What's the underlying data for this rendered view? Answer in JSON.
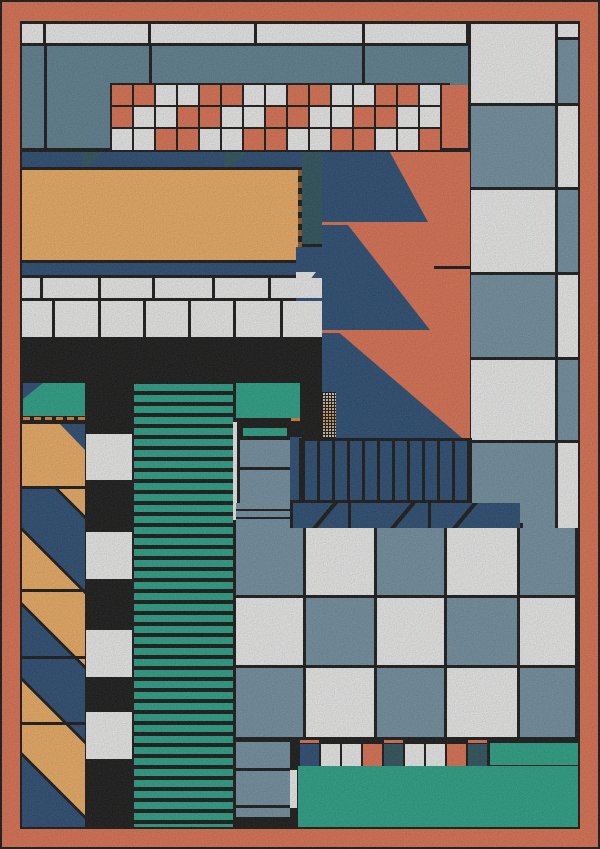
{
  "artwork": {
    "title_hint": "abstract-geometric-composition",
    "palette": {
      "black": "#181818",
      "coral": "#DC7152",
      "amber": "#EDAC63",
      "navy": "#2A4C72",
      "slate": "#7390A0",
      "slate2": "#5E808F",
      "dteal": "#2E525C",
      "teal": "#2AA185",
      "white": "#ECEDEC",
      "orange": "#E0812F",
      "dash": "#8A5A2D"
    },
    "letter_map": {
      "C": "coral",
      "W": "white",
      "S": "slate",
      "N": "navy",
      "D": "dteal",
      "O": "orange",
      "T": "teal",
      "K": "black",
      "A": "amber"
    },
    "tiles": [
      {
        "n": "outer-coral-border",
        "t": "rect",
        "x": 2,
        "y": 2,
        "w": 596,
        "h": 845,
        "c": "coral"
      },
      {
        "n": "inner-canvas",
        "t": "rect",
        "x": 20,
        "y": 21,
        "w": 560,
        "h": 808,
        "c": "black"
      },
      {
        "n": "top-white-row",
        "t": "cells",
        "x": 22,
        "y": 24,
        "cw": [
          21,
          102,
          103,
          105,
          101
        ],
        "rh": [
          19
        ],
        "gap": 3,
        "rows": [
          "WWWWW"
        ]
      },
      {
        "n": "top-slate-field",
        "t": "rect",
        "x": 22,
        "y": 46,
        "w": 446,
        "h": 102,
        "c": "slate2"
      },
      {
        "n": "top-slate-divider",
        "t": "rect",
        "x": 44,
        "y": 46,
        "w": 3,
        "h": 102,
        "c": "black"
      },
      {
        "n": "top-slate-divider",
        "t": "rect",
        "x": 149,
        "y": 46,
        "w": 3,
        "h": 102,
        "c": "black"
      },
      {
        "n": "top-slate-divider",
        "t": "rect",
        "x": 362,
        "y": 46,
        "w": 3,
        "h": 102,
        "c": "black"
      },
      {
        "n": "mosaic-grid-base",
        "t": "rect",
        "x": 110,
        "y": 83,
        "w": 340,
        "h": 67,
        "c": "black"
      },
      {
        "n": "mosaic-grid",
        "t": "cells",
        "x": 112,
        "y": 85,
        "cw": [
          20,
          20,
          20,
          20,
          20,
          20,
          20,
          20,
          20,
          20,
          20,
          20,
          20,
          20,
          20
        ],
        "rh": [
          20,
          20,
          21
        ],
        "gap": 2,
        "gy": 2,
        "rows": [
          "CCWWCCWWCCWWCCW",
          "CWWCCWWCCWWCCWW",
          "WWCCWWCCWWCCWWC"
        ]
      },
      {
        "n": "mosaic-coral-cap",
        "t": "rect",
        "x": 442,
        "y": 85,
        "w": 26,
        "h": 63,
        "c": "coral"
      },
      {
        "n": "rightcol-white-a",
        "t": "rect",
        "x": 471,
        "y": 24,
        "w": 84,
        "h": 79,
        "c": "white"
      },
      {
        "n": "rightcol-cap",
        "t": "rect",
        "x": 558,
        "y": 24,
        "w": 20,
        "h": 13,
        "c": "white"
      },
      {
        "n": "rightcol-strip-a",
        "t": "rect",
        "x": 558,
        "y": 40,
        "w": 20,
        "h": 63,
        "c": "slate"
      },
      {
        "n": "rightcol-slate-b",
        "t": "rect",
        "x": 471,
        "y": 106,
        "w": 84,
        "h": 81,
        "c": "slate"
      },
      {
        "n": "rightcol-strip-b",
        "t": "rect",
        "x": 558,
        "y": 106,
        "w": 20,
        "h": 81,
        "c": "white"
      },
      {
        "n": "rightcol-white-c",
        "t": "rect",
        "x": 471,
        "y": 190,
        "w": 84,
        "h": 82,
        "c": "white"
      },
      {
        "n": "rightcol-strip-c",
        "t": "rect",
        "x": 558,
        "y": 190,
        "w": 20,
        "h": 82,
        "c": "slate"
      },
      {
        "n": "rightcol-slate-d",
        "t": "rect",
        "x": 471,
        "y": 275,
        "w": 84,
        "h": 82,
        "c": "slate"
      },
      {
        "n": "rightcol-strip-d",
        "t": "rect",
        "x": 558,
        "y": 275,
        "w": 20,
        "h": 82,
        "c": "white"
      },
      {
        "n": "rightcol-white-e",
        "t": "rect",
        "x": 471,
        "y": 360,
        "w": 84,
        "h": 80,
        "c": "white"
      },
      {
        "n": "rightcol-strip-e",
        "t": "rect",
        "x": 558,
        "y": 360,
        "w": 20,
        "h": 80,
        "c": "slate"
      },
      {
        "n": "rightcol-slate-f",
        "t": "rect",
        "x": 471,
        "y": 443,
        "w": 84,
        "h": 80,
        "c": "slate"
      },
      {
        "n": "rightcol-strip-f",
        "t": "rect",
        "x": 558,
        "y": 443,
        "w": 20,
        "h": 80,
        "c": "white"
      },
      {
        "n": "sawtooth-coral-field",
        "t": "rect",
        "x": 322,
        "y": 152,
        "w": 148,
        "h": 291,
        "c": "coral"
      },
      {
        "n": "sawtooth-tooth-1",
        "t": "poly",
        "x": 322,
        "y": 152,
        "w": 106,
        "h": 70,
        "c": "navy",
        "pts": "0 0,64% 0,100% 100%,0 100%"
      },
      {
        "n": "sawtooth-tooth-2",
        "t": "poly",
        "x": 322,
        "y": 225,
        "w": 108,
        "h": 105,
        "c": "navy",
        "pts": "0 0,24% 0,100% 100%,0 100%"
      },
      {
        "n": "sawtooth-tooth-3",
        "t": "poly",
        "x": 322,
        "y": 333,
        "w": 146,
        "h": 110,
        "c": "navy",
        "pts": "0 0,12% 0,100% 100%,0 100%"
      },
      {
        "n": "coral-seam",
        "t": "rect",
        "x": 434,
        "y": 266,
        "w": 36,
        "h": 3,
        "c": "black"
      },
      {
        "n": "navy-band",
        "t": "rect",
        "x": 22,
        "y": 152,
        "w": 300,
        "h": 15,
        "c": "navy"
      },
      {
        "n": "band-wedge",
        "t": "poly",
        "x": 82,
        "y": 152,
        "w": 22,
        "h": 15,
        "c": "dteal",
        "pts": "0 0,100% 0,25% 100%,0 100%"
      },
      {
        "n": "band-wedge",
        "t": "poly",
        "x": 224,
        "y": 152,
        "w": 24,
        "h": 15,
        "c": "dteal",
        "pts": "0 0,100% 0,25% 100%,0 100%"
      },
      {
        "n": "dteal-column",
        "t": "rect",
        "x": 302,
        "y": 152,
        "w": 20,
        "h": 92,
        "c": "dteal"
      },
      {
        "n": "amber-panel",
        "t": "rect",
        "x": 22,
        "y": 170,
        "w": 276,
        "h": 90,
        "c": "amber"
      },
      {
        "n": "amber-panel-dashed-edge",
        "t": "vdash",
        "x": 298,
        "y": 170,
        "w": 4,
        "h": 90
      },
      {
        "n": "navy-underline",
        "t": "rect",
        "x": 22,
        "y": 263,
        "w": 300,
        "h": 12,
        "c": "navy"
      },
      {
        "n": "navy-knuckle",
        "t": "rect",
        "x": 296,
        "y": 247,
        "w": 26,
        "h": 90,
        "c": "navy"
      },
      {
        "n": "white-wedge",
        "t": "poly",
        "x": 296,
        "y": 272,
        "w": 20,
        "h": 26,
        "c": "white",
        "pts": "0 0,100% 0,0 100%"
      },
      {
        "n": "white-row-a",
        "t": "cells",
        "x": 22,
        "y": 278,
        "cw": [
          18,
          55,
          51,
          57,
          53,
          51
        ],
        "rh": [
          20
        ],
        "gap": 3,
        "rows": [
          "WWWWWW"
        ]
      },
      {
        "n": "white-row-b",
        "t": "cells",
        "x": 22,
        "y": 301,
        "cw": [
          30,
          43,
          42,
          42,
          42,
          44,
          39
        ],
        "rh": [
          36
        ],
        "gap": 3,
        "rows": [
          "WWWWWWW"
        ]
      },
      {
        "n": "black-band",
        "t": "rect",
        "x": 22,
        "y": 340,
        "w": 300,
        "h": 43,
        "c": "black"
      },
      {
        "n": "teal-block",
        "t": "rect",
        "x": 23,
        "y": 383,
        "w": 62,
        "h": 33,
        "c": "teal"
      },
      {
        "n": "teal-block-wedge",
        "t": "poly",
        "x": 23,
        "y": 383,
        "w": 20,
        "h": 16,
        "c": "navy",
        "pts": "0 0,100% 0,0 100%"
      },
      {
        "n": "orange-tick-row",
        "t": "cells",
        "x": 23,
        "y": 417,
        "cw": [
          7,
          7,
          7,
          7,
          7,
          7
        ],
        "rh": [
          3
        ],
        "gap": 4,
        "rows": [
          "OOOOOO"
        ]
      },
      {
        "n": "amber-block",
        "t": "rect",
        "x": 22,
        "y": 424,
        "w": 63,
        "h": 62,
        "c": "amber"
      },
      {
        "n": "amber-block-wedge",
        "t": "poly",
        "x": 60,
        "y": 424,
        "w": 25,
        "h": 26,
        "c": "navy",
        "pts": "0 0,100% 0,100% 100%"
      },
      {
        "n": "diagonal-column",
        "t": "diag",
        "x": 22,
        "y": 489,
        "w": 63,
        "h": 338
      },
      {
        "n": "diag-rule",
        "t": "rect",
        "x": 22,
        "y": 589,
        "w": 63,
        "h": 3,
        "c": "black"
      },
      {
        "n": "diag-rule",
        "t": "rect",
        "x": 22,
        "y": 656,
        "w": 63,
        "h": 3,
        "c": "black"
      },
      {
        "n": "diag-rule",
        "t": "rect",
        "x": 22,
        "y": 722,
        "w": 63,
        "h": 3,
        "c": "black"
      },
      {
        "n": "checker-column-base",
        "t": "rect",
        "x": 85,
        "y": 383,
        "w": 48,
        "h": 444,
        "c": "black"
      },
      {
        "n": "checker-column-white",
        "t": "rect",
        "x": 86,
        "y": 434,
        "w": 46,
        "h": 46,
        "c": "white"
      },
      {
        "n": "checker-column-white",
        "t": "rect",
        "x": 86,
        "y": 532,
        "w": 46,
        "h": 47,
        "c": "white"
      },
      {
        "n": "checker-column-white",
        "t": "rect",
        "x": 86,
        "y": 630,
        "w": 46,
        "h": 47,
        "c": "white"
      },
      {
        "n": "checker-column-white",
        "t": "rect",
        "x": 86,
        "y": 712,
        "w": 46,
        "h": 47,
        "c": "white"
      },
      {
        "n": "teal-stripe-column",
        "t": "hstripes",
        "x": 134,
        "y": 384,
        "w": 99,
        "h": 443
      },
      {
        "n": "teal-ledge",
        "t": "rect",
        "x": 236,
        "y": 383,
        "w": 64,
        "h": 35,
        "c": "teal"
      },
      {
        "n": "white-sliver",
        "t": "rect",
        "x": 233,
        "y": 422,
        "w": 4,
        "h": 98,
        "c": "white"
      },
      {
        "n": "teal-dash",
        "t": "rect",
        "x": 243,
        "y": 428,
        "w": 44,
        "h": 8,
        "c": "teal"
      },
      {
        "n": "slate-block",
        "t": "rect",
        "x": 240,
        "y": 440,
        "w": 50,
        "h": 27,
        "c": "slate"
      },
      {
        "n": "slate-block",
        "t": "rect",
        "x": 240,
        "y": 470,
        "w": 50,
        "h": 48,
        "c": "slate"
      },
      {
        "n": "slate-block",
        "t": "rect",
        "x": 240,
        "y": 521,
        "w": 50,
        "h": 6,
        "c": "slate"
      },
      {
        "n": "orange-dash",
        "t": "rect",
        "x": 291,
        "y": 418,
        "w": 9,
        "h": 3,
        "c": "orange"
      },
      {
        "n": "navy-sliver",
        "t": "rect",
        "x": 290,
        "y": 437,
        "w": 12,
        "h": 63,
        "c": "navy"
      },
      {
        "n": "dot-matrix",
        "t": "dots",
        "x": 322,
        "y": 392,
        "w": 14,
        "h": 49
      },
      {
        "n": "comb-frame",
        "t": "rect",
        "x": 299,
        "y": 438,
        "w": 173,
        "h": 65,
        "c": "black"
      },
      {
        "n": "comb-band",
        "t": "comb",
        "x": 302,
        "y": 441,
        "w": 167,
        "h": 59
      },
      {
        "n": "slash-left-slate",
        "t": "rect",
        "x": 236,
        "y": 503,
        "w": 54,
        "h": 25,
        "c": "slate"
      },
      {
        "n": "slash-left-rule",
        "t": "rect",
        "x": 236,
        "y": 509,
        "w": 54,
        "h": 2,
        "c": "black"
      },
      {
        "n": "slash-left-rule",
        "t": "rect",
        "x": 236,
        "y": 517,
        "w": 54,
        "h": 2,
        "c": "black"
      },
      {
        "n": "slash-band",
        "t": "rect",
        "x": 293,
        "y": 503,
        "w": 227,
        "h": 25,
        "c": "navy"
      },
      {
        "n": "slash-mark",
        "t": "poly",
        "x": 312,
        "y": 503,
        "w": 26,
        "h": 25,
        "c": "black",
        "pts": "80% 0,100% 0,20% 100%,0 100%"
      },
      {
        "n": "slash-mark",
        "t": "poly",
        "x": 390,
        "y": 503,
        "w": 26,
        "h": 25,
        "c": "black",
        "pts": "80% 0,100% 0,20% 100%,0 100%"
      },
      {
        "n": "slash-mark",
        "t": "poly",
        "x": 452,
        "y": 503,
        "w": 26,
        "h": 25,
        "c": "black",
        "pts": "80% 0,100% 0,20% 100%,0 100%"
      },
      {
        "n": "slash-divider",
        "t": "rect",
        "x": 348,
        "y": 503,
        "w": 3,
        "h": 25,
        "c": "black"
      },
      {
        "n": "slash-divider",
        "t": "rect",
        "x": 428,
        "y": 503,
        "w": 3,
        "h": 25,
        "c": "black"
      },
      {
        "n": "slash-right-slate",
        "t": "rect",
        "x": 523,
        "y": 503,
        "w": 32,
        "h": 25,
        "c": "slate"
      },
      {
        "n": "slash-right-white",
        "t": "rect",
        "x": 558,
        "y": 503,
        "w": 20,
        "h": 25,
        "c": "white"
      },
      {
        "n": "checkerboard",
        "t": "cells",
        "x": 236,
        "y": 528,
        "cw": [
          67,
          68,
          67,
          70,
          55
        ],
        "rh": [
          67,
          67,
          69
        ],
        "gap": 3,
        "gy": 3,
        "rows": [
          "SWSWS",
          "WSWSW",
          "SWSWS"
        ]
      },
      {
        "n": "bottom-slate-column",
        "t": "rect",
        "x": 236,
        "y": 742,
        "w": 54,
        "h": 75,
        "c": "slate"
      },
      {
        "n": "bottom-slate-rule",
        "t": "rect",
        "x": 236,
        "y": 768,
        "w": 54,
        "h": 3,
        "c": "black"
      },
      {
        "n": "bottom-slate-rule",
        "t": "rect",
        "x": 236,
        "y": 805,
        "w": 54,
        "h": 3,
        "c": "black"
      },
      {
        "n": "bottom-white-sliver",
        "t": "rect",
        "x": 290,
        "y": 770,
        "w": 7,
        "h": 38,
        "c": "white"
      },
      {
        "n": "bottom-mini-row",
        "t": "cells",
        "x": 300,
        "y": 744,
        "cw": [
          19,
          19,
          19,
          19,
          19,
          19,
          19,
          19,
          19
        ],
        "rh": [
          22
        ],
        "gap": 2,
        "rows": [
          "NWWCDWWCD"
        ]
      },
      {
        "n": "coral-tick",
        "t": "rect",
        "x": 300,
        "y": 740,
        "w": 19,
        "h": 3,
        "c": "coral"
      },
      {
        "n": "coral-tick",
        "t": "rect",
        "x": 384,
        "y": 740,
        "w": 19,
        "h": 3,
        "c": "coral"
      },
      {
        "n": "coral-tick",
        "t": "rect",
        "x": 468,
        "y": 740,
        "w": 19,
        "h": 3,
        "c": "coral"
      },
      {
        "n": "bottom-teal-step",
        "t": "rect",
        "x": 490,
        "y": 743,
        "w": 88,
        "h": 22,
        "c": "teal"
      },
      {
        "n": "bottom-teal-field",
        "t": "rect",
        "x": 298,
        "y": 766,
        "w": 280,
        "h": 61,
        "c": "teal"
      }
    ]
  }
}
